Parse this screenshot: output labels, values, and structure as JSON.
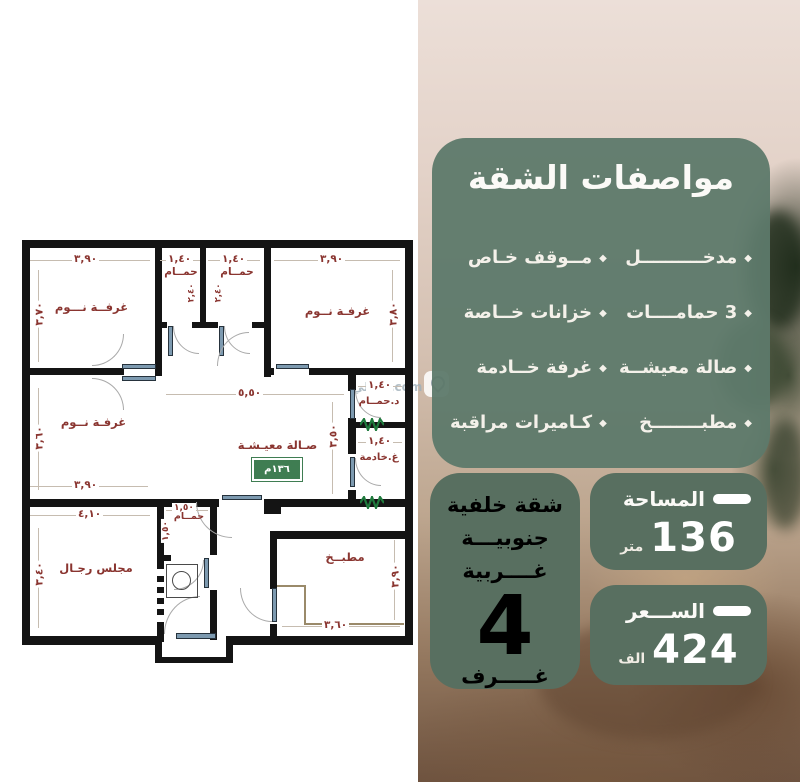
{
  "specs_panel": {
    "title": "مواصفات الشقة",
    "bullet": "◆",
    "items": [
      {
        "label": "مدخــــــــــل"
      },
      {
        "label": "مــوقف خـاص"
      },
      {
        "label": "3 حمامــــات"
      },
      {
        "label": "خزانات خــاصة"
      },
      {
        "label": "صالة معيشــة"
      },
      {
        "label": "غرفة خــادمة"
      },
      {
        "label": "مطبــــــــخ"
      },
      {
        "label": "كـاميرات مراقبة"
      }
    ]
  },
  "orientation_card": {
    "line1": "شقة خلفية",
    "line2": "جنوبيـــة",
    "line3": "غــــربية",
    "rooms_count": "4",
    "rooms_label": "غـــــرف"
  },
  "area_card": {
    "label": "المساحة",
    "value": "136",
    "unit": "متر"
  },
  "price_card": {
    "label": "الســـعر",
    "value": "424",
    "unit": "الف"
  },
  "plan": {
    "watermark": "عقالي.com",
    "rooms": [
      {
        "name": "bedroom-top-left",
        "label": "غرفــة نـــوم",
        "dim_top": "٣,٩٠",
        "dim_left": "٣,٧٠"
      },
      {
        "name": "bathroom-top-1",
        "label": "حمــام",
        "dim_top": "١,٤٠",
        "dim_side": "٢,٤٠"
      },
      {
        "name": "bathroom-top-2",
        "label": "حمــام",
        "dim_top": "١,٤٠",
        "dim_side": "٢,٤٠"
      },
      {
        "name": "bedroom-top-right",
        "label": "غرفـة نــوم",
        "dim_top": "٣,٩٠",
        "dim_right": "٣,٨٠"
      },
      {
        "name": "bedroom-mid-left",
        "label": "غرفـة نــوم",
        "dim_left": "٣,٦٠",
        "dim_bottom": "٣,٩٠"
      },
      {
        "name": "living-hall",
        "label": "صـالة معيـشـة",
        "dim_top": "٥,٥٠",
        "dim_right": "٣,٥٠",
        "area_badge": "١٣٦م"
      },
      {
        "name": "bathroom-right",
        "label": "د.حمــام",
        "dim_top": "١,٤٠"
      },
      {
        "name": "maid-room",
        "label": "غ.خادمة",
        "dim_top": "١,٤٠"
      },
      {
        "name": "majlis",
        "label": "مجلس رجـال",
        "dim_top": "٤,١٠",
        "dim_left": "٣,٤٠"
      },
      {
        "name": "bathroom-bottom",
        "label": "حمــام",
        "dim_top": "١,٥٠",
        "dim_left": "١,٥٠"
      },
      {
        "name": "kitchen",
        "label": "مطبــخ",
        "dim_bottom": "٣,٦٠",
        "dim_right": "٣,٩٠"
      }
    ]
  },
  "colors": {
    "panel_green": "#5f7a6b",
    "card_green": "#586f60",
    "plan_text_maroon": "#8a3530",
    "wall_black": "#141414",
    "window_green": "#1f7a3d",
    "door_blue": "#7d9ab0",
    "badge_green": "#3f7d52"
  }
}
